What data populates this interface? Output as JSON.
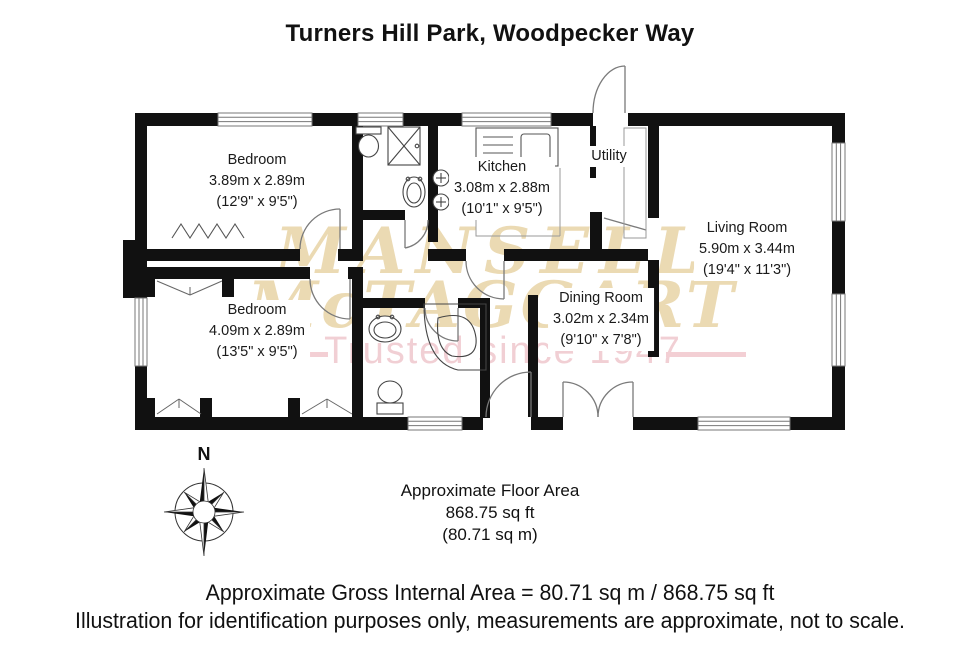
{
  "title": "Turners Hill Park, Woodpecker Way",
  "watermark": {
    "line1": "MANSELL",
    "line2": "McTAGGART",
    "tagline": "Trusted since 1947"
  },
  "compass": {
    "north_label": "N"
  },
  "rooms": {
    "bedroom1": {
      "name": "Bedroom",
      "metric": "3.89m x 2.89m",
      "imperial": "(12'9\" x 9'5\")"
    },
    "kitchen": {
      "name": "Kitchen",
      "metric": "3.08m x 2.88m",
      "imperial": "(10'1\" x 9'5\")"
    },
    "utility": {
      "name": "Utility"
    },
    "living": {
      "name": "Living Room",
      "metric": "5.90m x 3.44m",
      "imperial": "(19'4\" x 11'3\")"
    },
    "bedroom2": {
      "name": "Bedroom",
      "metric": "4.09m x 2.89m",
      "imperial": "(13'5\" x 9'5\")"
    },
    "dining": {
      "name": "Dining Room",
      "metric": "3.02m x 2.34m",
      "imperial": "(9'10\" x 7'8\")"
    }
  },
  "floor_area": {
    "line1": "Approximate Floor Area",
    "line2": "868.75 sq ft",
    "line3": "(80.71 sq m)"
  },
  "footer": {
    "line1": "Approximate Gross Internal Area = 80.71 sq m / 868.75 sq ft",
    "line2": "Illustration for identification purposes only, measurements are approximate, not to scale."
  },
  "colors": {
    "wall": "#111111",
    "watermark_gold": "#e9d6ab",
    "watermark_pink": "#f1cdd2"
  }
}
